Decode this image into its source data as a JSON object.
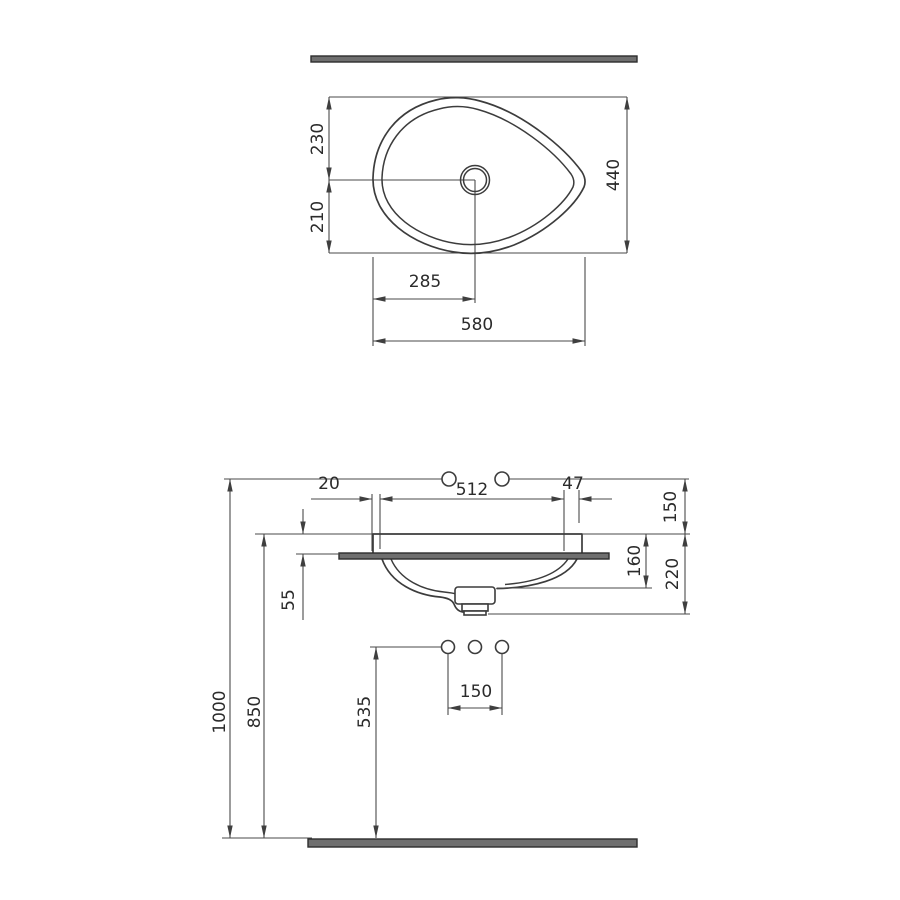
{
  "drawing": {
    "kind": "washbasin installation dimension drawing",
    "colors": {
      "line": "#3c3c3c",
      "slab_fill": "#6f6f6f",
      "slab_edge": "#2d2d2d",
      "text": "#2b2b2b",
      "background": "#ffffff"
    },
    "top_view": {
      "dims": {
        "center_to_top": "230",
        "center_to_bottom": "210",
        "total_depth": "440",
        "drain_from_left": "285",
        "total_width": "580"
      }
    },
    "front_view": {
      "dims": {
        "left_edge_gap": "20",
        "cutout_width": "512",
        "right_edge_gap": "47",
        "ref_to_rim": "150",
        "rim_to_waste_flange": "160",
        "rim_to_waste_bottom": "220",
        "rim_above_counter": "55",
        "hole_spacing": "150",
        "outlet_height": "535",
        "rim_height": "850",
        "ref_line_height": "1000"
      }
    }
  }
}
